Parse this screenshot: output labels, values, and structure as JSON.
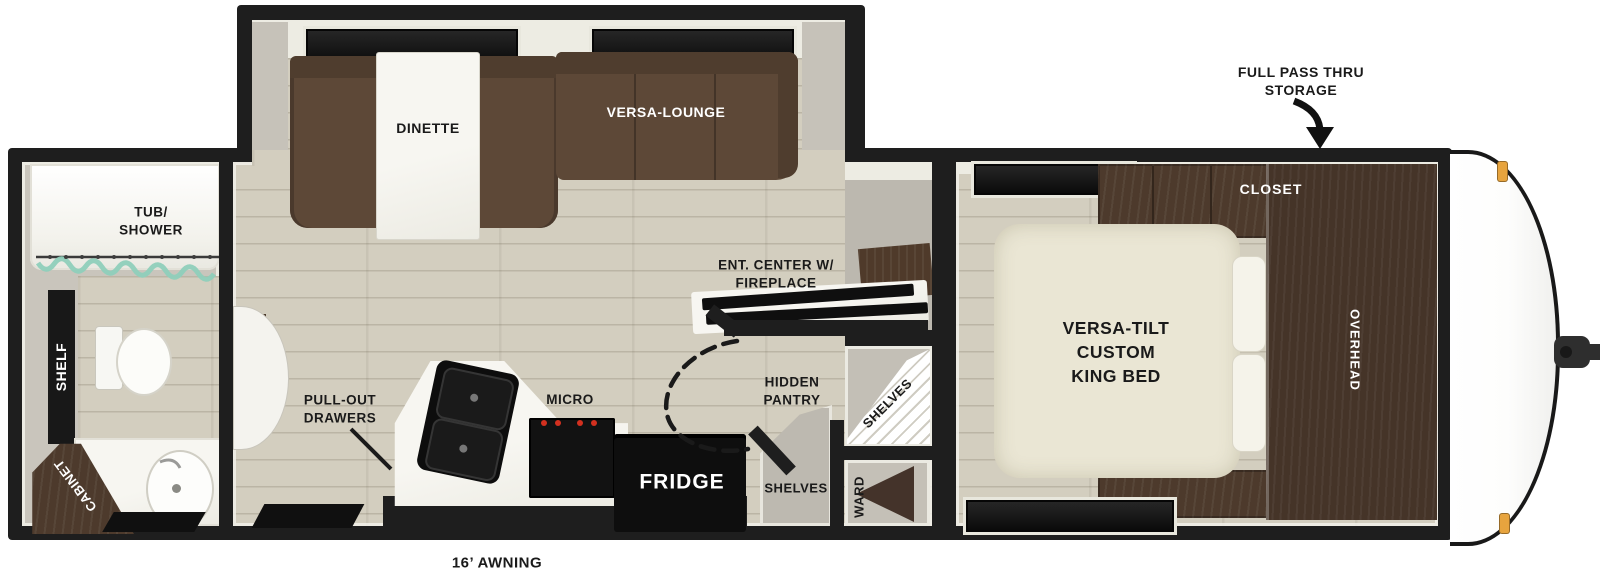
{
  "labels": {
    "bathroom": {
      "tub_shower": "TUB/\nSHOWER",
      "shelf": "SHELF",
      "cabinet": "CABINET"
    },
    "kitchen_living": {
      "dinette": "DINETTE",
      "versa_lounge": "VERSA-LOUNGE",
      "ent_center": "ENT. CENTER W/\nFIREPLACE",
      "pull_out_drawers": "PULL-OUT\nDRAWERS",
      "micro": "MICRO",
      "fridge": "FRIDGE",
      "hidden_pantry": "HIDDEN\nPANTRY",
      "pantry_shelves": "SHELVES",
      "corner_shelves": "SHELVES",
      "ward": "WARD"
    },
    "bedroom": {
      "king_bed": "VERSA-TILT\nCUSTOM\nKING BED",
      "closet": "CLOSET",
      "overhead": "OVERHEAD"
    },
    "exterior": {
      "full_pass_thru": "FULL PASS THRU\nSTORAGE",
      "awning": "16’ AWNING"
    }
  },
  "colors": {
    "wall_black": "#1e1e1e",
    "floor_tan": "#d3cebf",
    "interior_wall_gray": "#c6c2b9",
    "sofa_brown": "#5d4837",
    "cabinet_wood_brown": "#4a382b",
    "bed_cream": "#eae6d4",
    "shower_curtain_teal": "#8fcfba",
    "marker_light_orange": "#e7a43e",
    "appliance_black": "#121212",
    "burner_red": "#d3301f",
    "label_black": "#1a1a1a",
    "label_white": "#ffffff"
  }
}
